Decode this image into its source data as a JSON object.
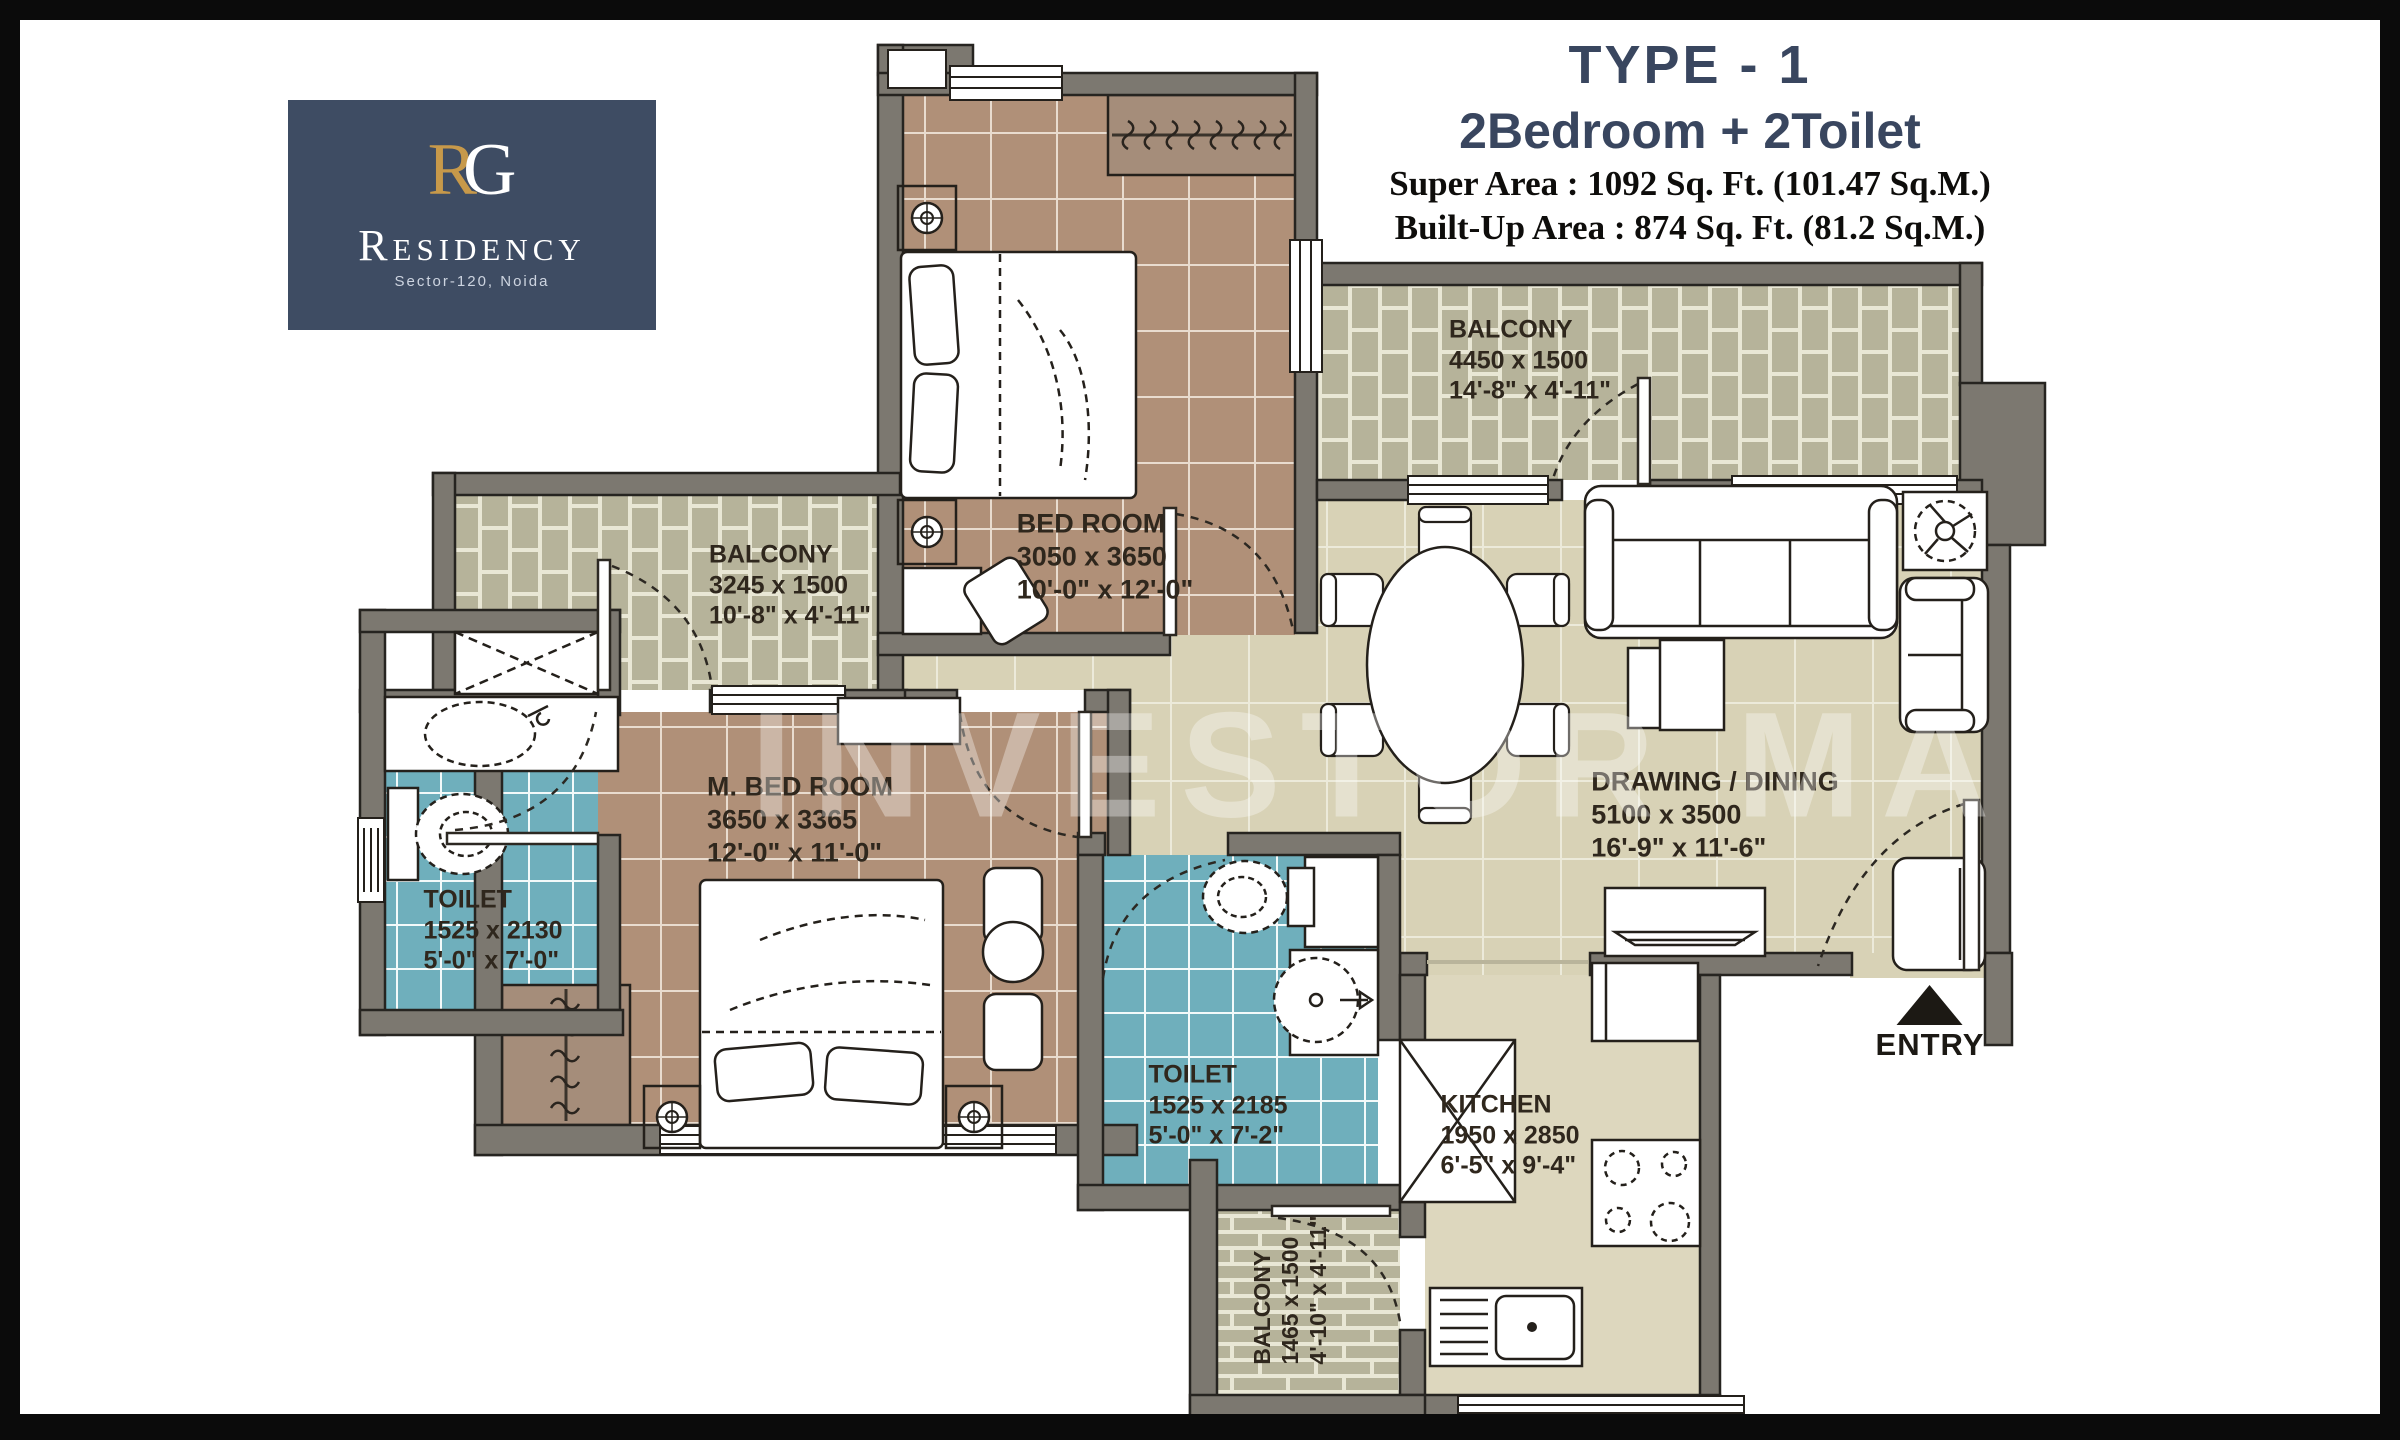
{
  "header": {
    "logo": {
      "monogram_r": "R",
      "monogram_g": "G",
      "name": "Residency",
      "location": "Sector-120, Noida"
    },
    "type_title": "TYPE - 1",
    "config_subtitle": "2Bedroom + 2Toilet",
    "super_area": "Super Area : 1092 Sq. Ft. (101.47 Sq.M.)",
    "built_up_area": "Built-Up Area : 874 Sq. Ft. (81.2 Sq.M.)"
  },
  "watermark": "INVESTOR MART",
  "entry": {
    "label": "ENTRY"
  },
  "rooms": {
    "bedroom": {
      "name": "BED ROOM",
      "dim_mm": "3050 x 3650",
      "dim_ft": "10'-0\" x 12'-0\""
    },
    "master_bedroom": {
      "name": "M. BED ROOM",
      "dim_mm": "3650 x 3365",
      "dim_ft": "12'-0\" x 11'-0\""
    },
    "drawing_dining": {
      "name": "DRAWING / DINING",
      "dim_mm": "5100 x 3500",
      "dim_ft": "16'-9\" x 11'-6\""
    },
    "kitchen": {
      "name": "KITCHEN",
      "dim_mm": "1950 x 2850",
      "dim_ft": "6'-5\" x 9'-4\""
    },
    "toilet_master": {
      "name": "TOILET",
      "dim_mm": "1525 x 2130",
      "dim_ft": "5'-0\" x 7'-0\""
    },
    "toilet_common": {
      "name": "TOILET",
      "dim_mm": "1525 x 2185",
      "dim_ft": "5'-0\" x 7'-2\""
    },
    "balcony_top": {
      "name": "BALCONY",
      "dim_mm": "4450 x 1500",
      "dim_ft": "14'-8\" x 4'-11\""
    },
    "balcony_left": {
      "name": "BALCONY",
      "dim_mm": "3245 x 1500",
      "dim_ft": "10'-8\" x 4'-11\""
    },
    "balcony_bottom": {
      "name": "BALCONY",
      "dim_mm": "1465 x 1500",
      "dim_ft": "4'-10\" x 4'-11\""
    }
  },
  "colors": {
    "wall": "#7c7870",
    "bedroom_floor": "#b09078",
    "toilet_floor": "#6fafbc",
    "balcony_floor": "#b6b39a",
    "living_floor": "#d8d2b6",
    "kitchen_floor": "#ddd7be",
    "logo_bg": "#3e4c63",
    "logo_gold": "#c7994a",
    "title_navy": "#39465f"
  }
}
